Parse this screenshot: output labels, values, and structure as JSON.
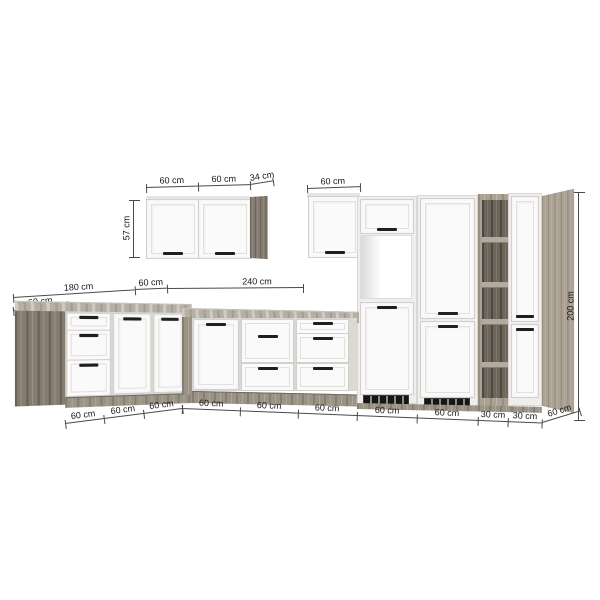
{
  "diagram_title": "kitchen-elevation-with-dimensions",
  "unit": "cm",
  "labels": {
    "wall_left_widths": [
      "60 cm",
      "60 cm",
      "34 cm"
    ],
    "wall_left_height": "57 cm",
    "wall_right_width": "60 cm",
    "plan": {
      "left_run": "180 cm",
      "corner": "60 cm",
      "main_run": "240 cm",
      "left_end_depth": "60 cm"
    },
    "tall_height": "200 cm",
    "bottom_left_run": [
      "60 cm",
      "60 cm",
      "60 cm"
    ],
    "bottom_main_run": [
      "60 cm",
      "60 cm",
      "60 cm",
      "60 cm",
      "60 cm",
      "30 cm",
      "30 cm"
    ],
    "bottom_right_depth": "60 cm"
  },
  "colors": {
    "background": "#ffffff",
    "cabinet_front": "#fafafa",
    "wood_dark": "#847c70",
    "wood_light": "#aba294",
    "countertop": "#b6afa4",
    "shelf_interior": "#6b655b",
    "handle": "#1f1f1f",
    "dimension_line": "#4a4a4a"
  }
}
